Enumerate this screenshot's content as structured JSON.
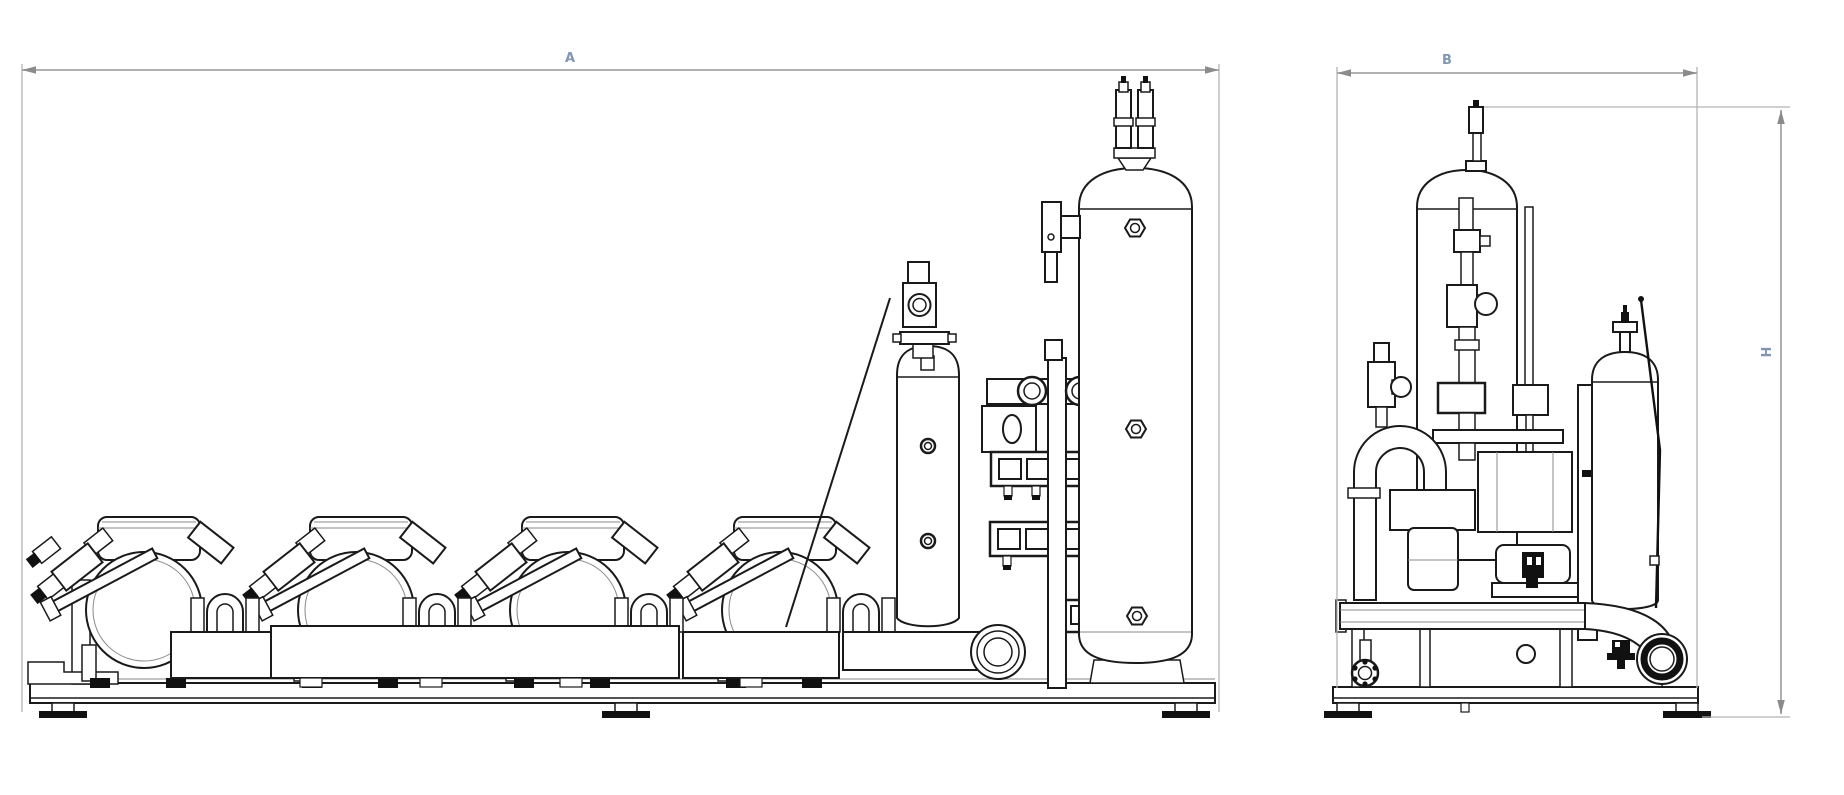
{
  "page": {
    "background": "#ffffff"
  },
  "drawing": {
    "type": "technical-orthographic-drawing",
    "subject": "refrigeration-compressor-rack-unit",
    "line_color": "#1a1a1a",
    "dimension_line_color": "#a6a6a6",
    "dimension_label_color": "#8096b4",
    "views": {
      "front": {
        "name": "front-view",
        "components": [
          "compressor-1",
          "compressor-2",
          "compressor-3",
          "compressor-4",
          "suction-header",
          "suction-loops",
          "oil-reservoir",
          "valve-station",
          "receiver-tank",
          "base-frame",
          "leveling-feet"
        ]
      },
      "side": {
        "name": "side-view",
        "components": [
          "suction-bend",
          "inlet-valve",
          "solenoid-valve-stack",
          "vertical-tank",
          "compressor-side-view",
          "oil-reservoir-side-view",
          "discharge-pipe",
          "flange",
          "base-frame",
          "leveling-feet"
        ]
      }
    }
  },
  "dimensions": {
    "a": {
      "label": "A",
      "meaning": "overall-length-front-view"
    },
    "b": {
      "label": "B",
      "meaning": "overall-depth-side-view"
    },
    "h": {
      "label": "H",
      "meaning": "overall-height"
    }
  }
}
